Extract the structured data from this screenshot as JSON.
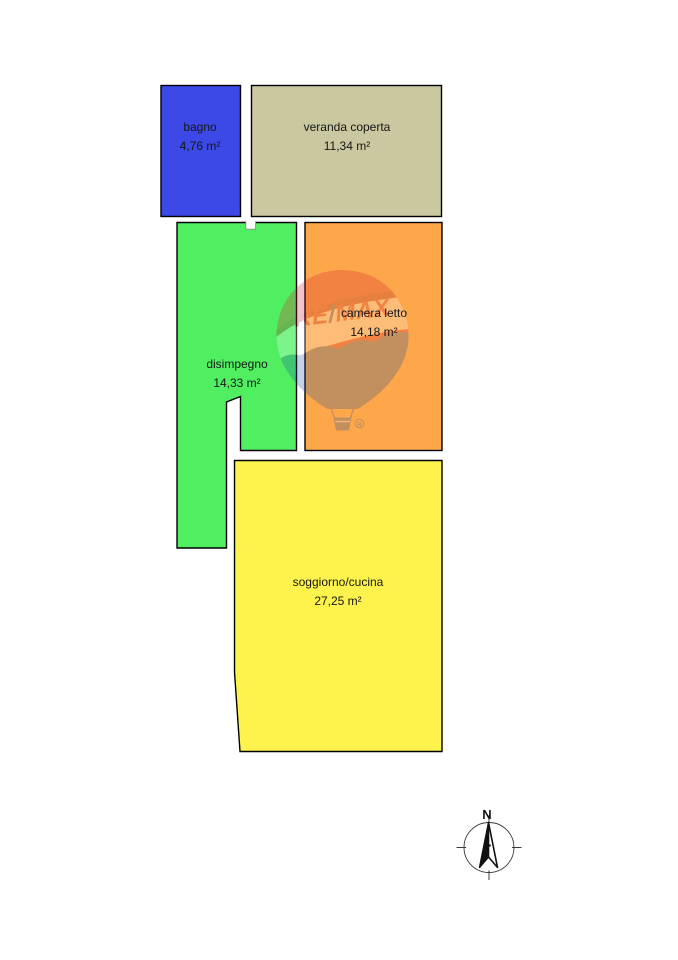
{
  "page": {
    "background": "#ffffff"
  },
  "plan": {
    "outline_color": "#000000",
    "label_color": "#161616",
    "rooms": [
      {
        "id": "bagno",
        "name": "bagno",
        "area": "4,76 m²",
        "color": "#3d49e6"
      },
      {
        "id": "veranda-coperta",
        "name": "veranda coperta",
        "area": "11,34 m²",
        "color": "#cac8a0"
      },
      {
        "id": "disimpegno",
        "name": "disimpegno",
        "area": "14,33 m²",
        "color": "#50ef62"
      },
      {
        "id": "camera-letto",
        "name": "camera letto",
        "area": "14,18 m²",
        "color": "#fda64a"
      },
      {
        "id": "soggiorno-cucina",
        "name": "soggiorno/cucina",
        "area": "27,25 m²",
        "color": "#fdf34c"
      }
    ]
  },
  "watermark": {
    "brand_re": "RE",
    "brand_slash": "/",
    "brand_max": "MAX",
    "red": "#d41f2c",
    "dark_red": "#a31520",
    "white": "#ffffff",
    "blue": "#1c4f9e",
    "registered_mark": "R"
  },
  "compass": {
    "north_label": "N"
  }
}
